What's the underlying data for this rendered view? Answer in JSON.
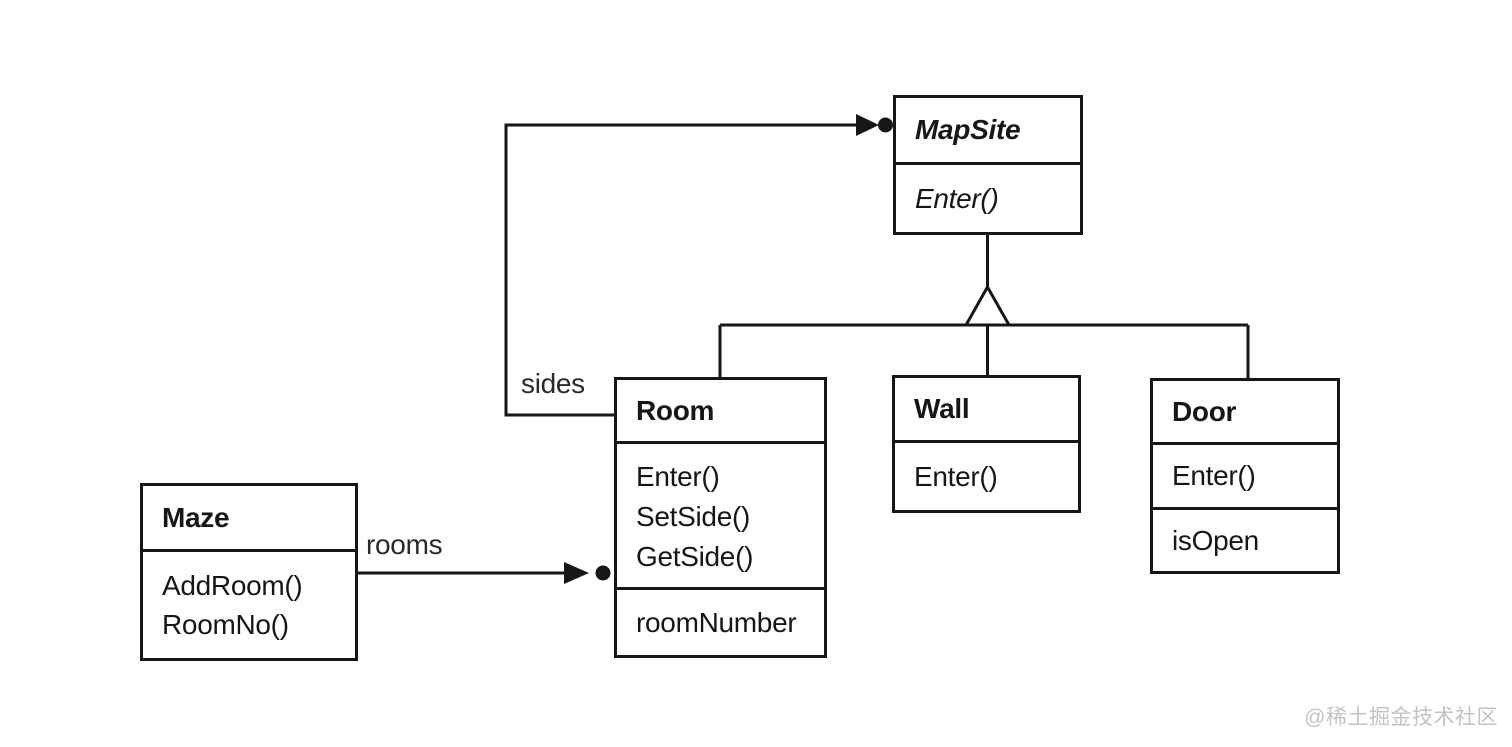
{
  "diagram": {
    "type": "uml-class-diagram",
    "classes": {
      "mapsite": {
        "name": "MapSite",
        "abstract": true,
        "methods": [
          "Enter()"
        ]
      },
      "room": {
        "name": "Room",
        "methods": [
          "Enter()",
          "SetSide()",
          "GetSide()"
        ],
        "attributes": [
          "roomNumber"
        ]
      },
      "wall": {
        "name": "Wall",
        "methods": [
          "Enter()"
        ]
      },
      "door": {
        "name": "Door",
        "methods": [
          "Enter()"
        ],
        "attributes": [
          "isOpen"
        ]
      },
      "maze": {
        "name": "Maze",
        "methods": [
          "AddRoom()",
          "RoomNo()"
        ]
      }
    },
    "inheritance": {
      "parent": "MapSite",
      "children": [
        "Room",
        "Wall",
        "Door"
      ]
    },
    "associations": [
      {
        "label": "rooms",
        "from": "Maze",
        "to": "Room",
        "multiplicity": "many"
      },
      {
        "label": "sides",
        "from": "Room",
        "to": "MapSite",
        "multiplicity": "many"
      }
    ],
    "colors": {
      "line": "#161616",
      "background": "#ffffff",
      "watermark": "#c3c3c3"
    }
  },
  "watermark": {
    "text": "@稀土掘金技术社区"
  }
}
